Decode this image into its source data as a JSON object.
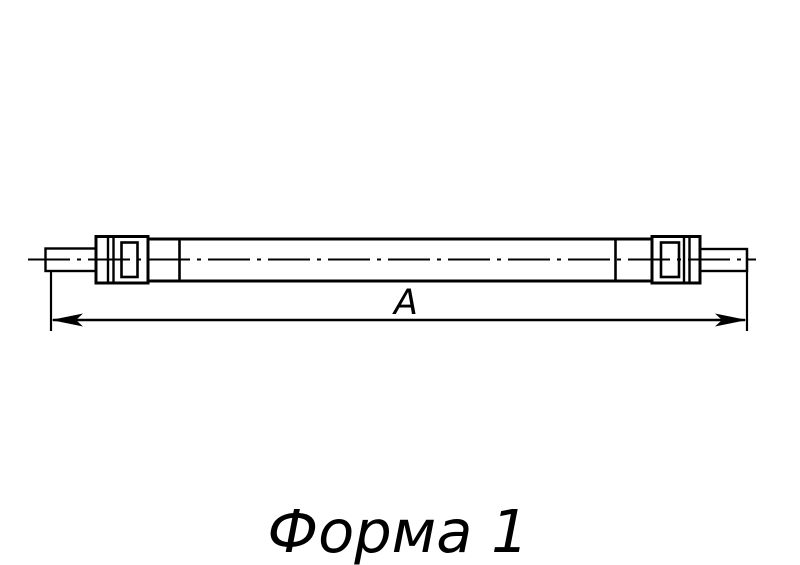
{
  "drawing": {
    "title": "",
    "dimension_label": "A",
    "caption": "Форма 1",
    "line_color": "#000000",
    "background_color": "#ffffff",
    "parts": {
      "left_rod": "threaded-rod-end-left",
      "left_coupler": "lock-nut-and-coupler-left",
      "tube": "main-shaft-tube",
      "right_coupler": "lock-nut-and-coupler-right",
      "right_rod": "threaded-rod-end-right"
    }
  }
}
